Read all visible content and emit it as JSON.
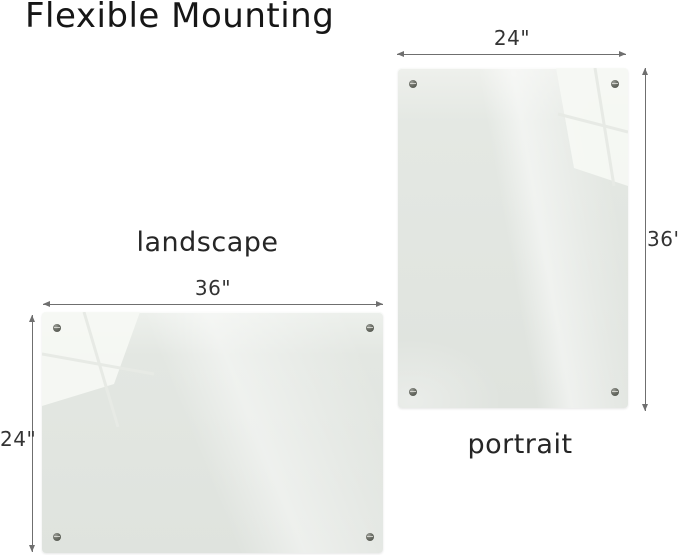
{
  "title": "Flexible Mounting",
  "boards": {
    "landscape": {
      "caption": "landscape",
      "width_dim": "36\"",
      "height_dim": "24\""
    },
    "portrait": {
      "caption": "portrait",
      "width_dim": "24\"",
      "height_dim": "36\""
    }
  },
  "colors": {
    "background": "#ffffff",
    "board_surface": "#e2e6e1",
    "board_reflection": "#f6f8f4",
    "dimension_line": "#6f6f6f",
    "text": "#1e1e1e",
    "screw": "#4b4e47"
  }
}
